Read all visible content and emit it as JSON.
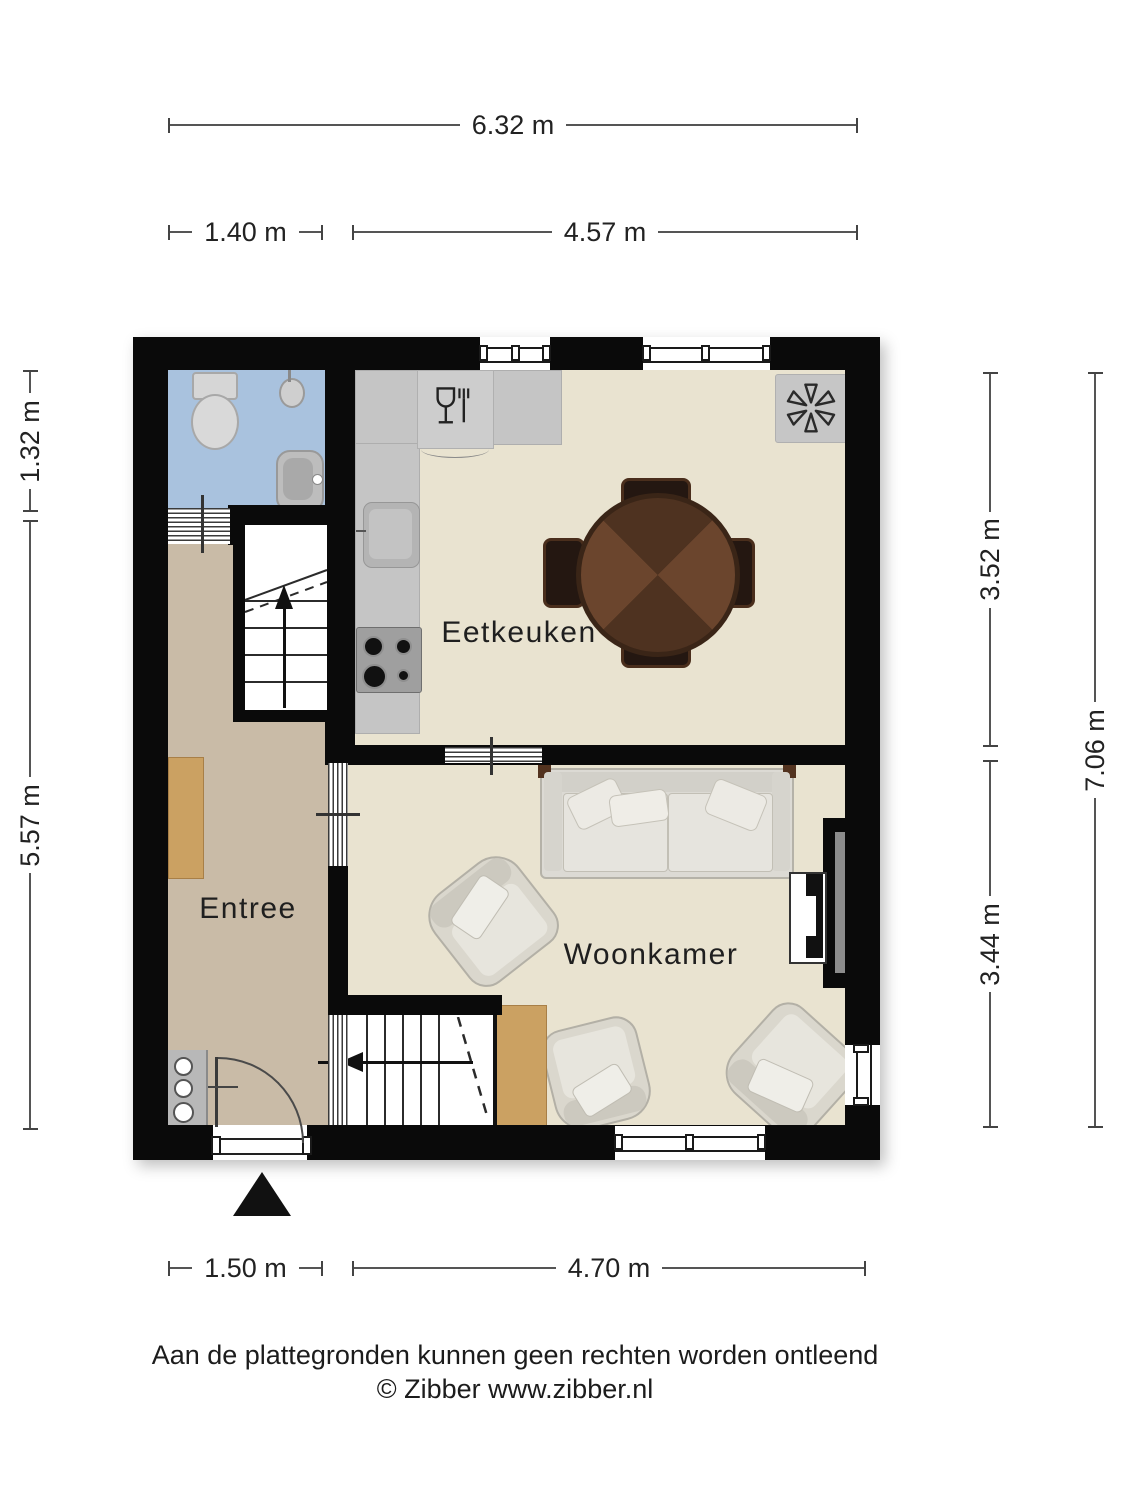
{
  "floorplan": {
    "rooms": [
      {
        "name": "Eetkeuken"
      },
      {
        "name": "Woonkamer"
      },
      {
        "name": "Entree"
      }
    ],
    "dimensions": {
      "top_total": "6.32 m",
      "top_left": "1.40 m",
      "top_right": "4.57 m",
      "bottom_left": "1.50 m",
      "bottom_right": "4.70 m",
      "left_upper": "1.32 m",
      "left_lower": "5.57 m",
      "right_upper": "3.52 m",
      "right_lower": "3.44 m",
      "right_total": "7.06 m"
    },
    "icons": {
      "ventilation": "fan-asterisk",
      "dishwasher": "wine-glass-fork",
      "stairs_up": "arrow-up",
      "stairs_down": "arrow-left",
      "entrance": "solid-triangle"
    },
    "colors": {
      "wall": "#0a0a0a",
      "floor_main": "#e9e3d0",
      "floor_entree": "#c9bba7",
      "floor_bathroom": "#a9c2de",
      "counter": "#c5c5c5",
      "wood": "#cba162",
      "table_wood": "#5a3a26",
      "dimension_line": "#555555"
    }
  },
  "footer": {
    "disclaimer": "Aan de plattegronden kunnen geen rechten worden ontleend",
    "credit": "© Zibber www.zibber.nl"
  }
}
